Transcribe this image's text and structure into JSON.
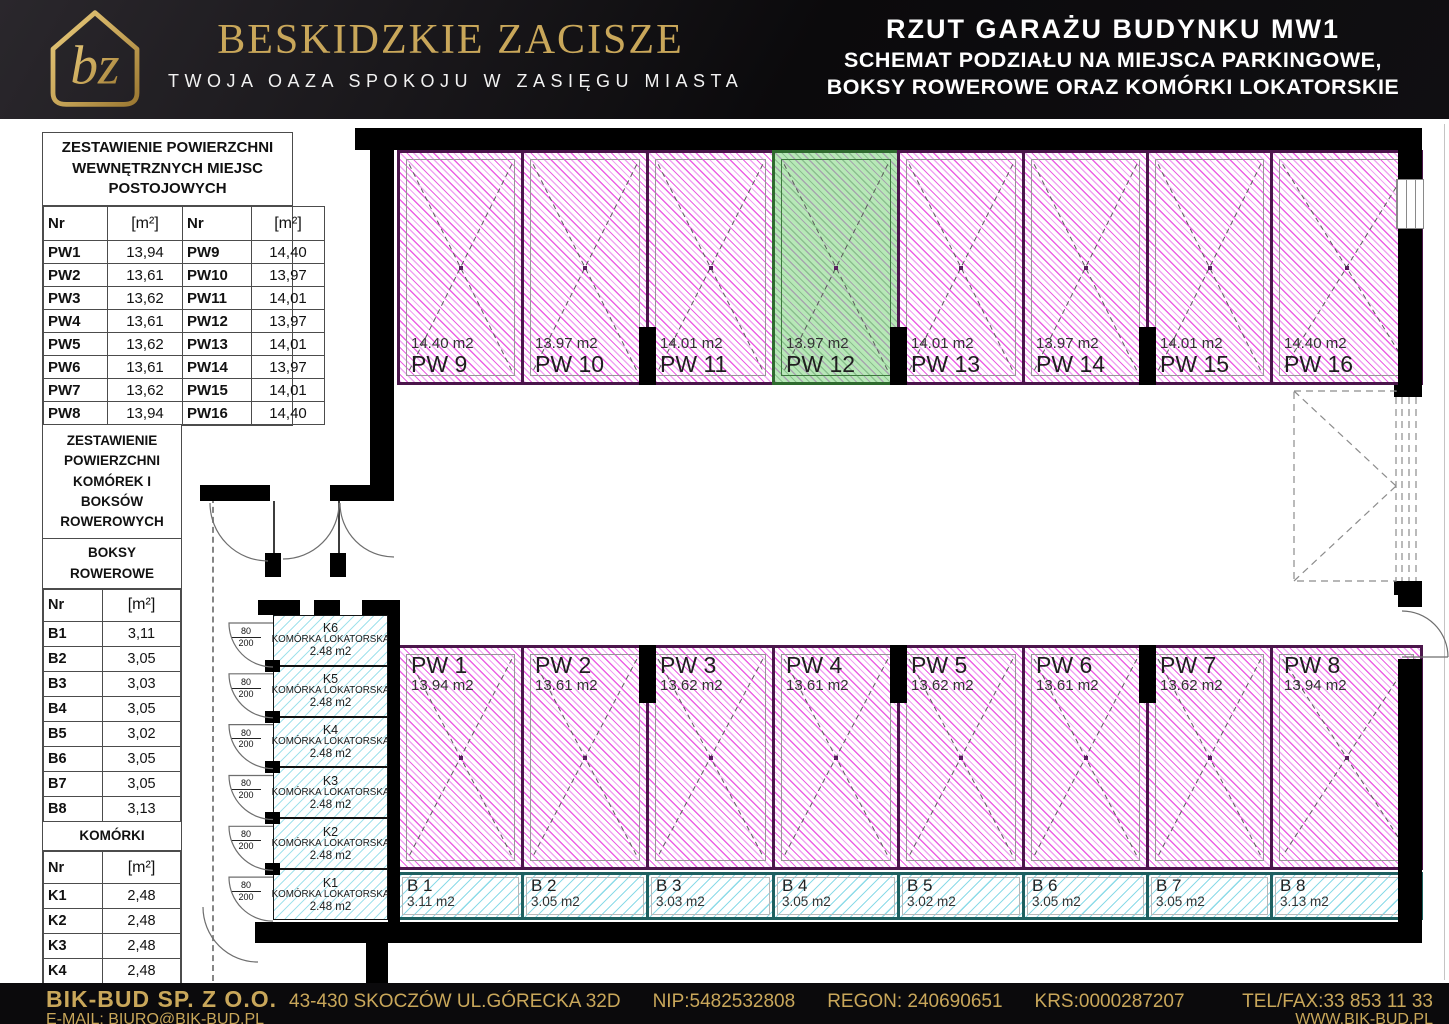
{
  "header": {
    "logo_monogram": "bz",
    "brand": "BESKIDZKIE ZACISZE",
    "tagline": "TWOJA OAZA SPOKOJU W ZASIĘGU MIASTA",
    "title_line1": "RZUT GARAŻU BUDYNKU MW1",
    "title_line2": "SCHEMAT PODZIAŁU NA MIEJSCA PARKINGOWE,",
    "title_line3": "BOKSY ROWEROWE ORAZ KOMÓRKI LOKATORSKIE"
  },
  "parking_table": {
    "title": "ZESTAWIENIE POWIERZCHNI WEWNĘTRZNYCH MIEJSC POSTOJOWYCH",
    "headers": [
      "Nr",
      "[m²]",
      "Nr",
      "[m²]"
    ],
    "rows": [
      [
        "PW1",
        "13,94",
        "PW9",
        "14,40"
      ],
      [
        "PW2",
        "13,61",
        "PW10",
        "13,97"
      ],
      [
        "PW3",
        "13,62",
        "PW11",
        "14,01"
      ],
      [
        "PW4",
        "13,61",
        "PW12",
        "13,97"
      ],
      [
        "PW5",
        "13,62",
        "PW13",
        "14,01"
      ],
      [
        "PW6",
        "13,61",
        "PW14",
        "13,97"
      ],
      [
        "PW7",
        "13,62",
        "PW15",
        "14,01"
      ],
      [
        "PW8",
        "13,94",
        "PW16",
        "14,40"
      ]
    ]
  },
  "storage_table": {
    "title": "ZESTAWIENIE POWIERZCHNI KOMÓREK I BOKSÓW ROWEROWYCH",
    "sections": [
      {
        "title": "BOKSY ROWEROWE",
        "headers": [
          "Nr",
          "[m²]"
        ],
        "rows": [
          [
            "B1",
            "3,11"
          ],
          [
            "B2",
            "3,05"
          ],
          [
            "B3",
            "3,03"
          ],
          [
            "B4",
            "3,05"
          ],
          [
            "B5",
            "3,02"
          ],
          [
            "B6",
            "3,05"
          ],
          [
            "B7",
            "3,05"
          ],
          [
            "B8",
            "3,13"
          ]
        ]
      },
      {
        "title": "KOMÓRKI",
        "headers": [
          "Nr",
          "[m²]"
        ],
        "rows": [
          [
            "K1",
            "2,48"
          ],
          [
            "K2",
            "2,48"
          ],
          [
            "K3",
            "2,48"
          ],
          [
            "K4",
            "2,48"
          ],
          [
            "K5",
            "2,48"
          ],
          [
            "K6",
            "2,48"
          ]
        ]
      }
    ]
  },
  "plan": {
    "parking_top": [
      {
        "id": "PW 9",
        "area": "14.40 m2"
      },
      {
        "id": "PW 10",
        "area": "13.97 m2"
      },
      {
        "id": "PW 11",
        "area": "14.01 m2"
      },
      {
        "id": "PW 12",
        "area": "13.97 m2",
        "highlight": true
      },
      {
        "id": "PW 13",
        "area": "14.01 m2"
      },
      {
        "id": "PW 14",
        "area": "13.97 m2"
      },
      {
        "id": "PW 15",
        "area": "14.01 m2"
      },
      {
        "id": "PW 16",
        "area": "14.40 m2"
      }
    ],
    "parking_bottom": [
      {
        "id": "PW 1",
        "area": "13.94 m2"
      },
      {
        "id": "PW 2",
        "area": "13.61 m2"
      },
      {
        "id": "PW 3",
        "area": "13.62 m2"
      },
      {
        "id": "PW 4",
        "area": "13.61 m2"
      },
      {
        "id": "PW 5",
        "area": "13.62 m2"
      },
      {
        "id": "PW 6",
        "area": "13.61 m2"
      },
      {
        "id": "PW 7",
        "area": "13.62 m2"
      },
      {
        "id": "PW 8",
        "area": "13.94 m2"
      }
    ],
    "bike_boxes": [
      {
        "id": "B 1",
        "area": "3.11 m2"
      },
      {
        "id": "B 2",
        "area": "3.05 m2"
      },
      {
        "id": "B 3",
        "area": "3.03 m2"
      },
      {
        "id": "B 4",
        "area": "3.05 m2"
      },
      {
        "id": "B 5",
        "area": "3.02 m2"
      },
      {
        "id": "B 6",
        "area": "3.05 m2"
      },
      {
        "id": "B 7",
        "area": "3.05 m2"
      },
      {
        "id": "B 8",
        "area": "3.13 m2"
      }
    ],
    "storage_units": [
      {
        "id": "K6",
        "label": "KOMÓRKA LOKATORSKA",
        "area": "2.48 m2"
      },
      {
        "id": "K5",
        "label": "KOMÓRKA LOKATORSKA",
        "area": "2.48 m2"
      },
      {
        "id": "K4",
        "label": "KOMÓRKA LOKATORSKA",
        "area": "2.48 m2"
      },
      {
        "id": "K3",
        "label": "KOMÓRKA LOKATORSKA",
        "area": "2.48 m2"
      },
      {
        "id": "K2",
        "label": "KOMÓRKA LOKATORSKA",
        "area": "2.48 m2"
      },
      {
        "id": "K1",
        "label": "KOMÓRKA LOKATORSKA",
        "area": "2.48 m2"
      }
    ],
    "door_dimension": {
      "width": "80",
      "height": "200"
    }
  },
  "footer": {
    "company": "BIK-BUD SP. Z O.O.",
    "address": "43-430 SKOCZÓW UL.GÓRECKA 32D",
    "nip": "NIP:5482532808",
    "regon": "REGON: 240690651",
    "krs": "KRS:0000287207",
    "tel": "TEL/FAX:33 853 11 33",
    "email": "E-MAIL: BIURO@BIK-BUD.PL",
    "www": "WWW.BIK-BUD.PL"
  },
  "colors": {
    "gold": "#c9a75a",
    "header_bg": "#0f0e10",
    "stall_border": "#4b164b",
    "stall_hatch": "#e438de",
    "highlight_fill": "#b7e8b7",
    "highlight_border": "#2e6b2e",
    "bike_border": "#1f6060",
    "bike_hatch": "#70d2e2"
  }
}
